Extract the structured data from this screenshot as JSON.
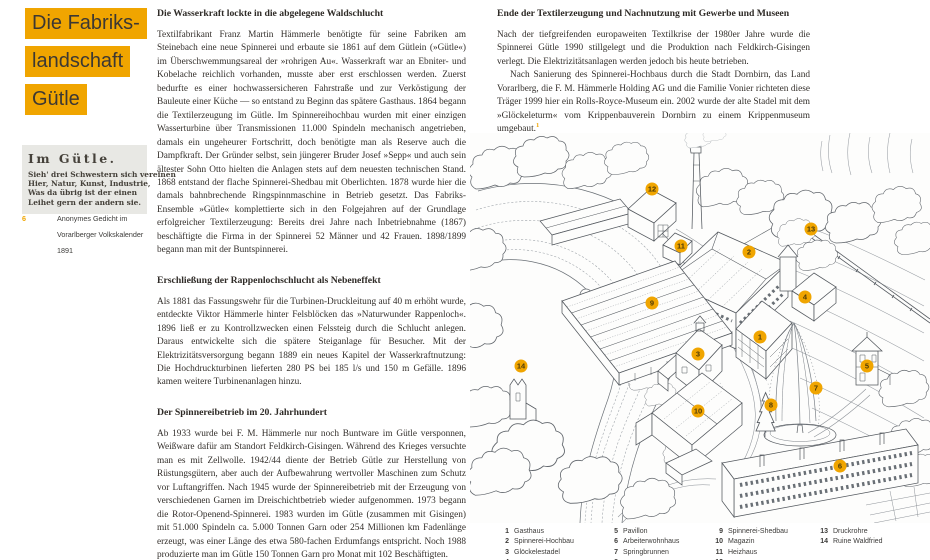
{
  "colors": {
    "accent": "#F0A500",
    "ink": "#332f2b",
    "poem_box_bg": "#e8e8e4",
    "drawing_ink": "#565b61"
  },
  "title": {
    "lines": [
      "Die Fabriks-",
      "landschaft",
      "Gütle"
    ]
  },
  "poem": {
    "title": "Im Gütle.",
    "lines": [
      "Sieh' drei Schwestern sich vereinen",
      "Hier, Natur, Kunst, Industrie,",
      "Was da übrig ist der einen",
      "Leihet gern der andern sie."
    ]
  },
  "poem_caption": {
    "num": "6",
    "text": "Anonymes Gedicht im Vorarlberger Volkskalender 1891"
  },
  "articles": {
    "mid": [
      {
        "heading": "Die Wasserkraft lockte in die abgelegene Waldschlucht",
        "paragraphs": [
          "Textilfabrikant Franz Martin Hämmerle benötigte für seine Fabriken am Steinebach eine neue Spinnerei und erbaute sie 1861 auf dem Gütlein (»Gütle«) im Überschwemmungsareal der »rohrigen Au«. Wasserkraft war an Ebniter- und Kobelache reichlich vorhanden, musste aber erst erschlossen werden. Zuerst bedurfte es einer hochwassersicheren Fahrstraße und zur Verköstigung der Bauleute einer Küche — so entstand zu Beginn das spätere Gasthaus. 1864 begann die Textilerzeugung im Gütle. Im Spinnereihochbau wurden mit einer einzigen Wasserturbine über Transmissionen 11.000 Spindeln mechanisch angetrieben, damals ein ungeheurer Fortschritt, doch benötigte man als Reserve auch die Dampfkraft. Der Gründer selbst, sein jüngerer Bruder Josef »Sepp« und auch sein ältester Sohn Otto hielten die Anlagen stets auf dem neuesten technischen Stand. 1868 entstand der flache Spinnerei-Shedbau mit Oberlichten. 1878 wurde hier die damals bahnbrechende Ringspinnmaschine in Betrieb gesetzt. Das Fabriks-Ensemble »Gütle« komplettierte sich in den Folgejahren auf der Grundlage erfolgreicher Textilerzeugung: Bereits drei Jahre nach Inbetriebnahme (1867) beschäftigte die Firma in der Spinnerei 52 Männer und 42 Frauen. 1898/1899 begann man mit der Buntspinnerei."
        ]
      },
      {
        "heading": "Erschließung der Rappenlochschlucht als Nebeneffekt",
        "paragraphs": [
          "Als 1881 das Fassungswehr für die Turbinen-Druckleitung auf 40 m erhöht wurde, entdeckte Viktor Hämmerle hinter Felsblöcken das »Naturwunder Rappenloch«. 1896 ließ er zu Kontrollzwecken einen Felssteig durch die Schlucht anlegen. Daraus entwickelte sich die spätere Steiganlage für Besucher. Mit der Elektrizitätsversorgung begann 1889 ein neues Kapitel der Wasserkraftnutzung: Die Hochdruckturbinen lieferten 280 PS bei 185 l/s und 150 m Gefälle. 1896 kamen weitere Turbinenanlagen hinzu."
        ]
      },
      {
        "heading": "Der Spinnereibetrieb im 20. Jahrhundert",
        "paragraphs": [
          "Ab 1933 wurde bei F. M. Hämmerle nur noch Buntware im Gütle versponnen, Weißware dafür am Standort Feldkirch-Gisingen. Während des Krieges versuchte man es mit Zellwolle. 1942/44 diente der Betrieb Gütle zur Herstellung von Rüstungsgütern, aber auch der Aufbewahrung wertvoller Maschinen zum Schutz vor Luftangriffen. Nach 1945 wurde der Spinnereibetrieb mit der Erzeugung von verschiedenen Garnen im Dreischichtbetrieb wieder aufgenommen. 1973 begann die Rotor-Openend-Spinnerei. 1983 wurden im Gütle (zusammen mit Gisingen) mit 51.000 Spindeln ca. 5.000 Tonnen Garn oder 254 Millionen km Fadenlänge erzeugt, was einer Länge des etwa 580-fachen Erdumfangs entspricht. Noch 1988 produzierte man im Gütle 150 Tonnen Garn pro Monat mit 102 Beschäftigten."
        ]
      }
    ],
    "right": {
      "heading": "Ende der Textilerzeugung und Nachnutzung mit Gewerbe und Museen",
      "para1": "Nach der tiefgreifenden europaweiten Textilkrise der 1980er Jahre wurde die Spinnerei Gütle 1990 stillgelegt und die Produktion nach Feldkirch-Gisingen verlegt. Die Elektrizitätsanlagen werden jedoch bis heute betrieben.",
      "para2": "Nach Sanierung des Spinnerei-Hochbaus durch die Stadt Dornbirn, das Land Vorarlberg, die F. M. Hämmerle Holding AG und die Familie Vonier richteten diese Träger 1999 hier ein Rolls-Royce-Museum ein. 2002 wurde der alte Stadel mit dem »Glöckeleturm« vom Krippenbauverein Dornbirn zu einem Krippenmuseum umgebaut.",
      "footnote_mark": "1"
    }
  },
  "legend": {
    "col1": [
      {
        "num": "1",
        "label": "Gasthaus"
      },
      {
        "num": "2",
        "label": "Spinnerei-Hochbau"
      },
      {
        "num": "3",
        "label": "Glöckelestadel"
      },
      {
        "num": "4",
        "label": ""
      }
    ],
    "col2": [
      {
        "num": "5",
        "label": "Pavillon"
      },
      {
        "num": "6",
        "label": "Arbeiterwohnhaus"
      },
      {
        "num": "7",
        "label": "Springbrunnen"
      },
      {
        "num": "8",
        "label": ""
      }
    ],
    "col3": [
      {
        "num": "9",
        "label": "Spinnerei-Shedbau"
      },
      {
        "num": "10",
        "label": "Magazin"
      },
      {
        "num": "11",
        "label": "Heizhaus"
      },
      {
        "num": "12",
        "label": ""
      }
    ],
    "col4": [
      {
        "num": "13",
        "label": "Druckrohre"
      },
      {
        "num": "14",
        "label": "Ruine Waldfried"
      }
    ]
  },
  "illustration": {
    "marker_color": "#F0A500",
    "markers": [
      {
        "n": "12",
        "x": 182,
        "y": 56
      },
      {
        "n": "13",
        "x": 341,
        "y": 96
      },
      {
        "n": "11",
        "x": 211,
        "y": 113
      },
      {
        "n": "2",
        "x": 279,
        "y": 119
      },
      {
        "n": "4",
        "x": 335,
        "y": 164
      },
      {
        "n": "9",
        "x": 182,
        "y": 170
      },
      {
        "n": "1",
        "x": 290,
        "y": 204
      },
      {
        "n": "3",
        "x": 228,
        "y": 221
      },
      {
        "n": "14",
        "x": 51,
        "y": 233
      },
      {
        "n": "5",
        "x": 397,
        "y": 233
      },
      {
        "n": "7",
        "x": 346,
        "y": 255
      },
      {
        "n": "8",
        "x": 301,
        "y": 272
      },
      {
        "n": "10",
        "x": 228,
        "y": 278
      },
      {
        "n": "6",
        "x": 370,
        "y": 333
      }
    ]
  }
}
